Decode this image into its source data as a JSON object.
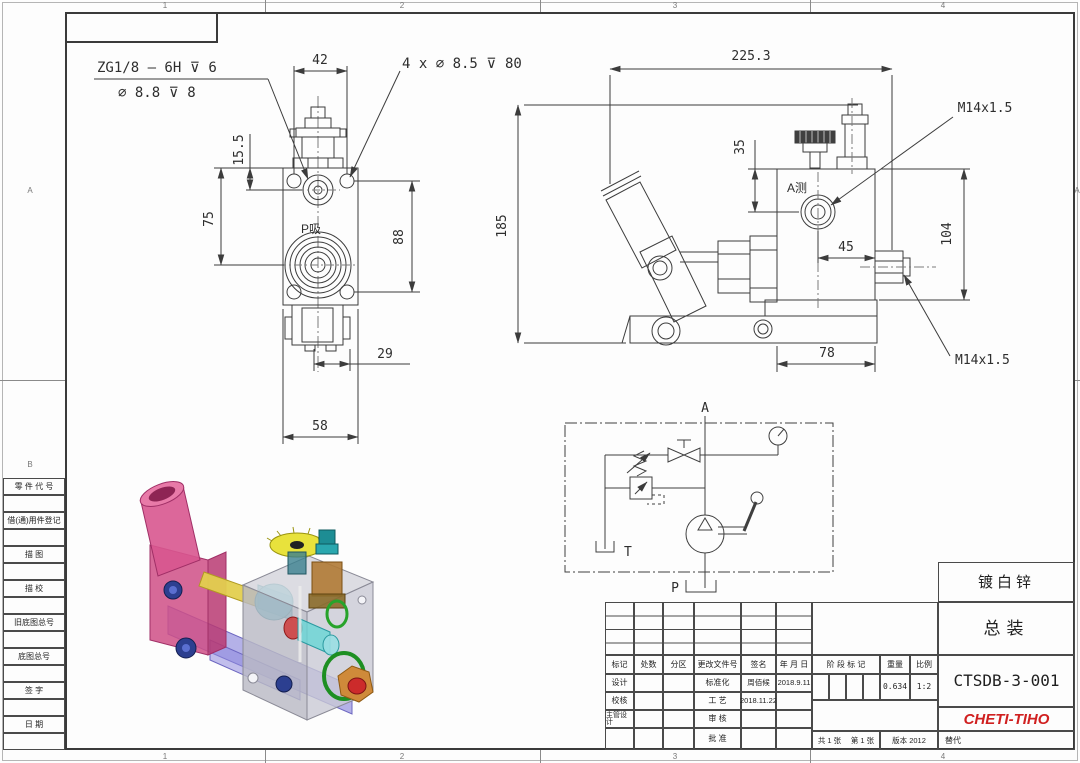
{
  "zones": {
    "top": [
      "1",
      "2",
      "3",
      "4"
    ],
    "bottom": [
      "1",
      "2",
      "3",
      "4"
    ],
    "left": [
      "A",
      "B"
    ],
    "right": [
      "A"
    ]
  },
  "side_panel": {
    "rows": [
      "零 件 代 号",
      "借(通)用件登记",
      "描 图",
      "描 校",
      "旧底图总号",
      "底图总号",
      "签 字",
      "日 期"
    ]
  },
  "front_view": {
    "note_thread": "ZG1/8 — 6H ⊽ 6",
    "note_hole": "∅ 8.8 ⊽ 8",
    "note_pattern": "4 x ∅ 8.5 ⊽ 80",
    "port_label": "P吸",
    "dim_width_top": "42",
    "dim_offset": "15.5",
    "dim_left": "75",
    "dim_right": "88",
    "dim_bottom_small": "29",
    "dim_bottom": "58"
  },
  "side_view": {
    "port_label": "A测",
    "dim_overall_w": "225.3",
    "dim_top": "35",
    "dim_port": "45",
    "dim_height": "104",
    "dim_width": "78",
    "dim_overall_h": "185",
    "thread_top": "M14x1.5",
    "thread_side": "M14x1.5"
  },
  "schematic": {
    "port_a": "A",
    "port_p": "P",
    "tank": "T"
  },
  "title_block": {
    "finish": "镀白锌",
    "title": "总装",
    "drawing_no": "CTSDB-3-001",
    "company": "CHETI-TIHO",
    "replace": "替代",
    "version": "版本 2012",
    "sheet_total": "共 1 张",
    "sheet_no": "第 1 张",
    "stage_label": "阶 段 标 记",
    "weight_label": "重量",
    "scale_label": "比例",
    "weight_value": "0.634",
    "scale_value": "1:2",
    "rev_headers": [
      "标记",
      "处数",
      "分区",
      "更改文件号",
      "签名",
      "年 月 日"
    ],
    "rows": [
      {
        "left": "设计",
        "mid": "标准化",
        "sign": "周佰候",
        "date": "2018.9.11"
      },
      {
        "left": "校核",
        "mid": "工 艺",
        "sign": "2018.11.22",
        "date": ""
      },
      {
        "left": "主管设计",
        "mid": "审 核",
        "sign": "",
        "date": ""
      },
      {
        "left": "",
        "mid": "批 准",
        "sign": "",
        "date": ""
      }
    ]
  }
}
